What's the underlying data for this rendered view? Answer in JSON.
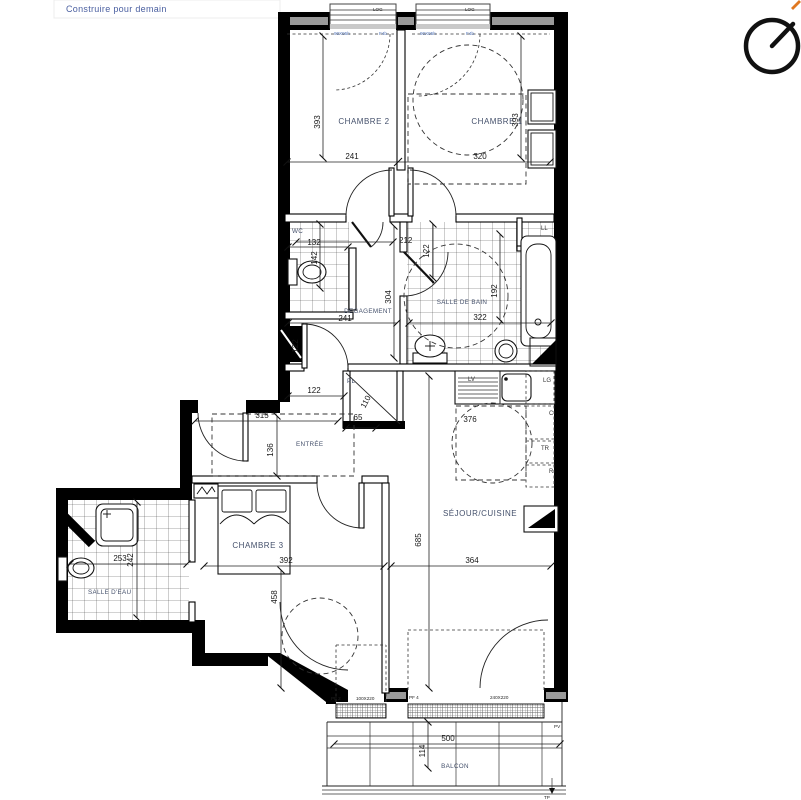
{
  "branding": {
    "tagline": "Construire pour demain"
  },
  "rooms": {
    "chambre2": {
      "label": "CHAMBRE 2",
      "width": "241",
      "height": "393"
    },
    "chambre1": {
      "label": "CHAMBRE 1",
      "width": "320",
      "height": "393"
    },
    "wc": {
      "label": "WC",
      "width": "132",
      "depth": "142"
    },
    "degagement": {
      "label": "DEGAGEMENT",
      "width": "241",
      "height": "304",
      "dim_passage": "212",
      "dim_door": "122",
      "dim_left": "122",
      "dim_bottom": "122"
    },
    "salle_de_bain": {
      "label": "SALLE DE BAIN",
      "width": "322",
      "depth": "192"
    },
    "placard": {
      "label": "PL",
      "dim_diag": "110",
      "dim_width": "65"
    },
    "entree": {
      "label": "ENTRÉE",
      "width": "315",
      "depth": "136"
    },
    "chambre3": {
      "label": "CHAMBRE 3",
      "width": "392",
      "height": "458"
    },
    "salle_deau": {
      "label": "SALLE D'EAU",
      "width": "253",
      "depth": "242"
    },
    "sejour": {
      "label": "SÉJOUR/CUISINE",
      "width": "364",
      "height": "685",
      "dim_kitchen": "376"
    },
    "balcon": {
      "label": "BALCON",
      "width": "500",
      "depth": "114"
    }
  },
  "appliances": {
    "washer": "LL",
    "dishwasher": "LV",
    "lg": "LG",
    "c": "C",
    "tr": "TR",
    "r": "R"
  },
  "openings": {
    "window_tag": "LOG",
    "window_note_size": "90X95h",
    "window_note_type": "F4b",
    "pf2_tag": "PF 2",
    "pf2_size": "100X220",
    "pf4_tag": "PF 4",
    "pf4_size": "240X220",
    "pv": "PV",
    "tp": "TP"
  },
  "colors": {
    "wall": "#000000",
    "label": "#44506b",
    "dimension": "#181818",
    "annotation_blue": "#5577bb",
    "logo_blue": "#4a5fa0",
    "north_accent": "#e07820"
  }
}
